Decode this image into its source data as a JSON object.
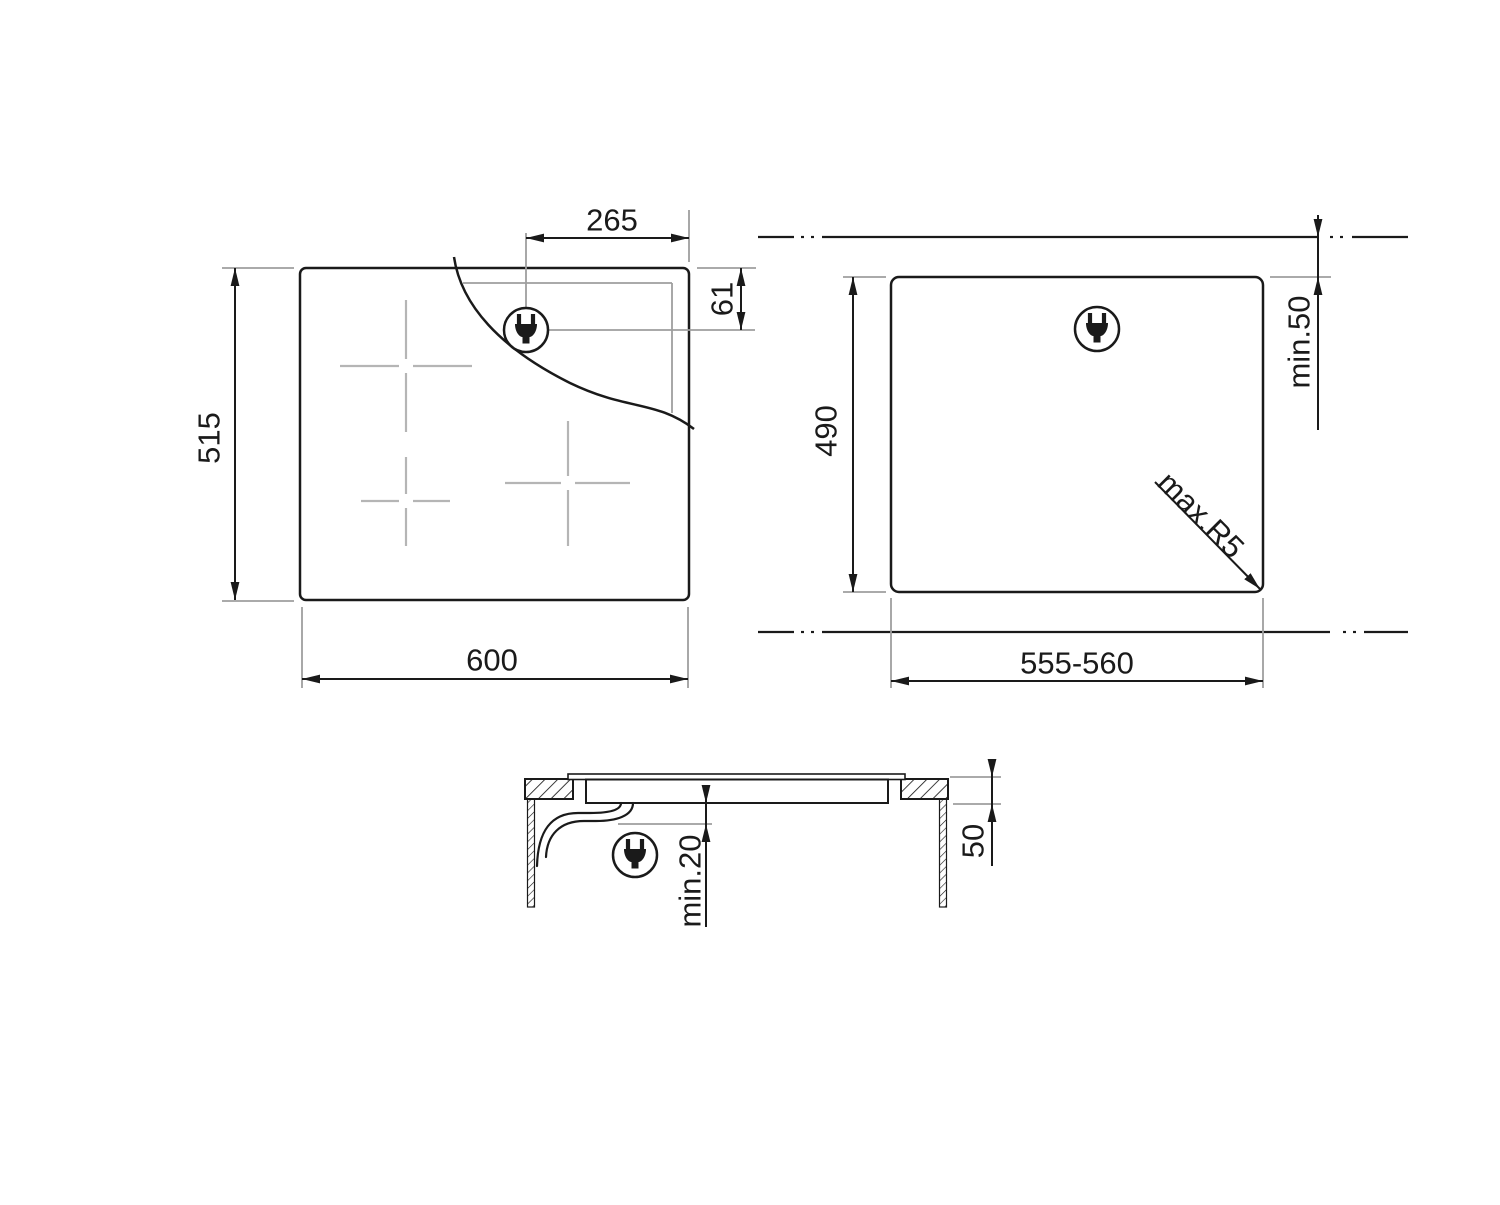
{
  "top_view": {
    "width": "600",
    "height": "515",
    "plug_offset_from_right": "265",
    "plug_offset_from_top": "61",
    "plug_icon": "power-plug-icon"
  },
  "cutout_view": {
    "width": "555-560",
    "height": "490",
    "min_distance_to_edge": "min.50",
    "max_corner_radius": "max.R5",
    "plug_icon": "power-plug-icon"
  },
  "section_view": {
    "recess_depth": "50",
    "min_clearance_below": "min.20",
    "plug_icon": "power-plug-icon"
  },
  "colors": {
    "line": "#1a1a1a",
    "extension_line": "#9e9e9e",
    "zone_marker": "#b5b5b5",
    "background": "#ffffff"
  }
}
